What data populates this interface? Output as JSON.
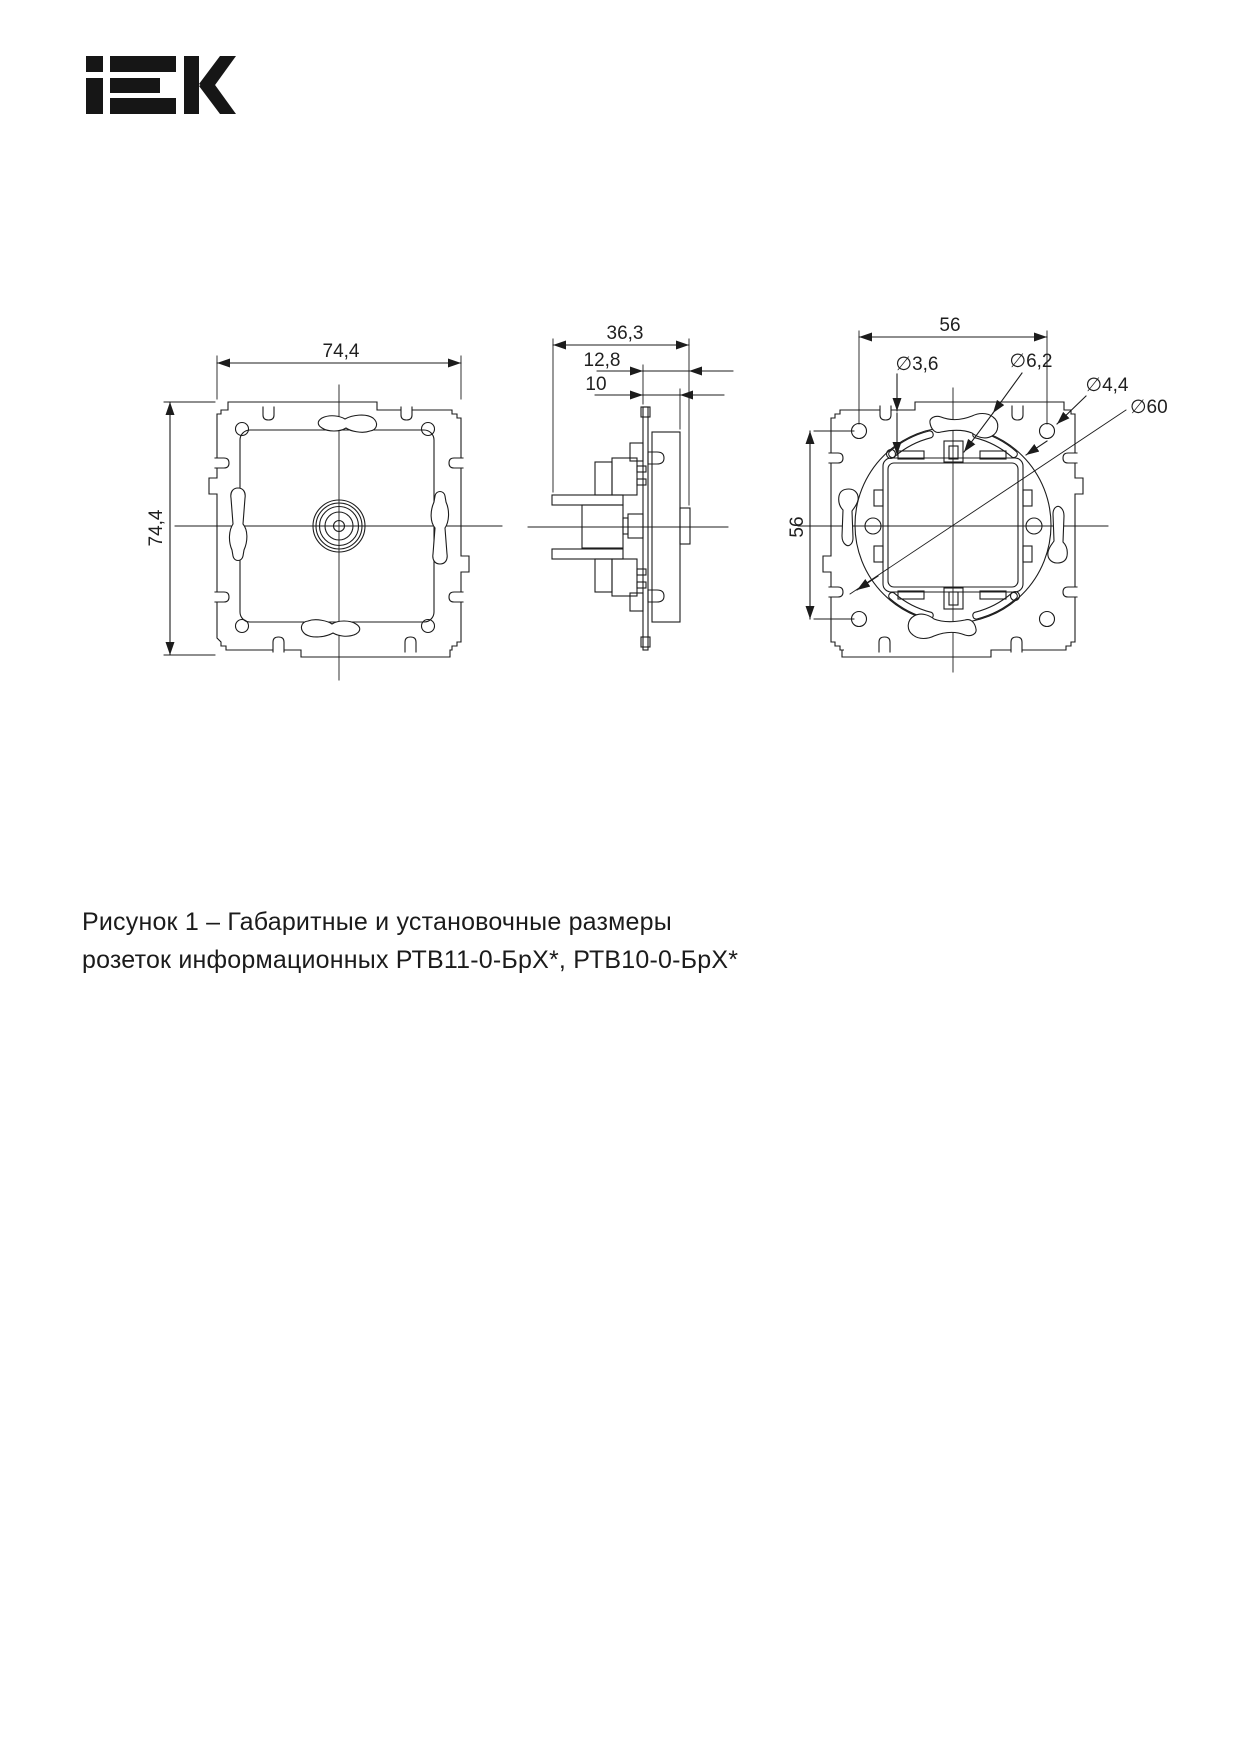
{
  "logo": {
    "brand": "IEK"
  },
  "drawing": {
    "front_view": {
      "dim_width": "74,4",
      "dim_height": "74,4"
    },
    "side_view": {
      "dim_depth": "36,3",
      "dim_cover": "12,8",
      "dim_face": "10"
    },
    "back_view": {
      "dim_hole_spacing_h": "56",
      "dim_hole_spacing_v": "56",
      "dia_arc_hole": "∅3,6",
      "dia_slot": "∅6,2",
      "dia_corner_hole": "∅4,4",
      "dia_mount_circle": "∅60"
    }
  },
  "caption": {
    "line1": "Рисунок 1 – Габаритные и установочные размеры",
    "line2": "розеток информационных РТВ11-0-БрХ*, РТВ10-0-БрХ*"
  }
}
